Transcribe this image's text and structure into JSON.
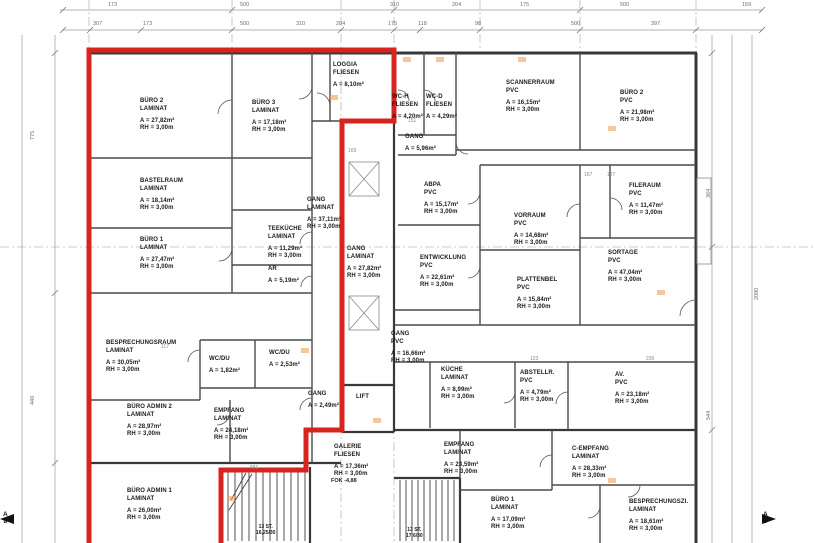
{
  "drawing_type": "floor-plan",
  "colors": {
    "red_outline": "#d8231e",
    "wall": "#383838",
    "dimension_text": "#6f6f6f",
    "marker_orange": "#eca557"
  },
  "rooms": [
    {
      "name": "BÜRO 2",
      "material": "LAMINAT",
      "area": "A = 27,82m²",
      "rh": "RH =  3,00m",
      "x": 140,
      "y": 98
    },
    {
      "name": "BÜRO 3",
      "material": "LAMINAT",
      "area": "A = 17,18m²",
      "rh": "RH =  3,00m",
      "x": 252,
      "y": 100
    },
    {
      "name": "LOGGIA",
      "material": "FLIESEN",
      "area": "A = 8,10m²",
      "rh": "",
      "x": 333,
      "y": 62
    },
    {
      "name": "BASTELRAUM",
      "material": "LAMINAT",
      "area": "A = 18,14m²",
      "rh": "RH =  3,00m",
      "x": 140,
      "y": 178
    },
    {
      "name": "BÜRO 1",
      "material": "LAMINAT",
      "area": "A = 27,47m²",
      "rh": "RH =  3,00m",
      "x": 140,
      "y": 237
    },
    {
      "name": "GANG",
      "material": "LAMINAT",
      "area": "A = 37,11m²",
      "rh": "RH =  3,00m",
      "x": 307,
      "y": 197
    },
    {
      "name": "TEEKÜCHE",
      "material": "LAMINAT",
      "area": "A = 11,29m²",
      "rh": "RH =  3,00m",
      "x": 268,
      "y": 226
    },
    {
      "name": "AR",
      "material": "",
      "area": "A = 5,19m²",
      "rh": "",
      "x": 268,
      "y": 266
    },
    {
      "name": "BESPRECHUNGSRAUM",
      "material": "LAMINAT",
      "area": "A = 30,05m²",
      "rh": "RH =  3,00m",
      "x": 106,
      "y": 340
    },
    {
      "name": "WC/DU",
      "material": "",
      "area": "A = 1,82m²",
      "rh": "",
      "x": 209,
      "y": 356
    },
    {
      "name": "WC/DU",
      "material": "",
      "area": "A = 2,53m²",
      "rh": "",
      "x": 269,
      "y": 350
    },
    {
      "name": "BÜRO ADMIN 2",
      "material": "LAMINAT",
      "area": "A = 28,97m²",
      "rh": "RH =  3,00m",
      "x": 127,
      "y": 404
    },
    {
      "name": "EMPFANG",
      "material": "LAMINAT",
      "area": "A = 24,18m²",
      "rh": "RH =  3,00m",
      "x": 214,
      "y": 408
    },
    {
      "name": "GANG",
      "material": "",
      "area": "A = 2,49m²",
      "rh": "",
      "x": 308,
      "y": 391
    },
    {
      "name": "LIFT",
      "material": "",
      "area": "",
      "rh": "",
      "x": 356,
      "y": 394
    },
    {
      "name": "BÜRO ADMIN 1",
      "material": "LAMINAT",
      "area": "A = 26,00m²",
      "rh": "RH =  3,00m",
      "x": 127,
      "y": 488
    },
    {
      "name": "GALERIE",
      "material": "FLIESEN",
      "area": "A = 17,36m²",
      "rh": "RH =  3,00m",
      "x": 334,
      "y": 444
    },
    {
      "name": "GANG",
      "material": "LAMINAT",
      "area": "A = 27,82m²",
      "rh": "RH =  3,00m",
      "x": 347,
      "y": 246
    },
    {
      "name": "WC-H",
      "material": "FLIESEN",
      "area": "A = 4,20m²",
      "rh": "",
      "x": 392,
      "y": 94
    },
    {
      "name": "WC-D",
      "material": "FLIESEN",
      "area": "A = 4,29m²",
      "rh": "",
      "x": 426,
      "y": 94
    },
    {
      "name": "SCANNERRAUM",
      "material": "PVC",
      "area": "A = 16,15m²",
      "rh": "RH =  3,00m",
      "x": 506,
      "y": 80
    },
    {
      "name": "BÜRO 2",
      "material": "PVC",
      "area": "A = 21,98m²",
      "rh": "RH =  3,00m",
      "x": 620,
      "y": 90
    },
    {
      "name": "GANG",
      "material": "",
      "area": "A = 5,96m²",
      "rh": "",
      "x": 405,
      "y": 134
    },
    {
      "name": "ABPA",
      "material": "PVC",
      "area": "A = 15,17m²",
      "rh": "RH =  3,00m",
      "x": 424,
      "y": 182
    },
    {
      "name": "FILERAUM",
      "material": "PVC",
      "area": "A = 11,47m²",
      "rh": "RH =  3,00m",
      "x": 629,
      "y": 183
    },
    {
      "name": "VORRAUM",
      "material": "PVC",
      "area": "A = 14,68m²",
      "rh": "RH =  3,00m",
      "x": 514,
      "y": 213
    },
    {
      "name": "ENTWICKLUNG",
      "material": "PVC",
      "area": "A = 22,61m²",
      "rh": "RH =  3,00m",
      "x": 420,
      "y": 255
    },
    {
      "name": "SORTAGE",
      "material": "PVC",
      "area": "A = 47,04m²",
      "rh": "RH =  3,00m",
      "x": 608,
      "y": 250
    },
    {
      "name": "PLATTENBEL",
      "material": "PVC",
      "area": "A = 15,84m²",
      "rh": "RH =  3,00m",
      "x": 517,
      "y": 277
    },
    {
      "name": "GANG",
      "material": "PVC",
      "area": "A = 16,66m²",
      "rh": "RH =  3,00m",
      "x": 391,
      "y": 331
    },
    {
      "name": "KÜCHE",
      "material": "LAMINAT",
      "area": "A = 8,99m²",
      "rh": "RH =  3,00m",
      "x": 441,
      "y": 367
    },
    {
      "name": "ABSTELLR.",
      "material": "PVC",
      "area": "A = 4,79m²",
      "rh": "RH =  3,00m",
      "x": 520,
      "y": 370
    },
    {
      "name": "AV.",
      "material": "PVC",
      "area": "A = 23,18m²",
      "rh": "RH =  3,00m",
      "x": 615,
      "y": 372
    },
    {
      "name": "EMPFANG",
      "material": "LAMINAT",
      "area": "A = 23,59m²",
      "rh": "RH =  3,00m",
      "x": 444,
      "y": 442
    },
    {
      "name": "BÜRO 1",
      "material": "LAMINAT",
      "area": "A = 17,09m²",
      "rh": "RH =  3,00m",
      "x": 491,
      "y": 497
    },
    {
      "name": "C-EMPFANG",
      "material": "LAMINAT",
      "area": "A = 28,33m²",
      "rh": "RH =  3,00m",
      "x": 572,
      "y": 446
    },
    {
      "name": "BESPRECHUNGSZI.",
      "material": "LAMINAT",
      "area": "A = 18,61m²",
      "rh": "RH =  3,00m",
      "x": 629,
      "y": 499
    }
  ],
  "stair_labels": [
    {
      "line1": "13 ST.",
      "line2": "16,25/30",
      "x": 256,
      "y": 524
    },
    {
      "line1": "13 ST.",
      "line2": "17,6/30",
      "x": 406,
      "y": 527
    }
  ],
  "wall_note": {
    "text": "FOK -4,88"
  },
  "dimensions": {
    "top_row1": [
      {
        "t": "173",
        "x": 108
      },
      {
        "t": "500",
        "x": 240
      },
      {
        "t": "310",
        "x": 390
      },
      {
        "t": "204",
        "x": 452
      },
      {
        "t": "175",
        "x": 520
      },
      {
        "t": "500",
        "x": 620
      },
      {
        "t": "159",
        "x": 742
      }
    ],
    "top_row2": [
      {
        "t": "307",
        "x": 93
      },
      {
        "t": "173",
        "x": 143
      },
      {
        "t": "500",
        "x": 240
      },
      {
        "t": "310",
        "x": 296
      },
      {
        "t": "204",
        "x": 336
      },
      {
        "t": "175",
        "x": 388
      },
      {
        "t": "118",
        "x": 418
      },
      {
        "t": "98",
        "x": 475
      },
      {
        "t": "500",
        "x": 571
      },
      {
        "t": "397",
        "x": 651
      }
    ],
    "left": [
      {
        "t": "775",
        "x": 30,
        "y": 140
      },
      {
        "t": "440",
        "x": 30,
        "y": 405
      }
    ],
    "right": [
      {
        "t": "364",
        "x": 706,
        "y": 198
      },
      {
        "t": "544",
        "x": 706,
        "y": 420
      },
      {
        "t": "2080",
        "x": 754,
        "y": 300
      }
    ]
  },
  "minor_dims": [
    {
      "t": "169",
      "x": 348,
      "y": 148
    },
    {
      "t": "117",
      "x": 161,
      "y": 344
    },
    {
      "t": "151",
      "x": 408,
      "y": 118
    },
    {
      "t": "167",
      "x": 584,
      "y": 172
    },
    {
      "t": "127",
      "x": 607,
      "y": 172
    },
    {
      "t": "581",
      "x": 250,
      "y": 465
    },
    {
      "t": "123",
      "x": 530,
      "y": 356
    },
    {
      "t": "230",
      "x": 646,
      "y": 356
    }
  ],
  "markers": [
    {
      "x": 330,
      "y": 95
    },
    {
      "x": 403,
      "y": 57
    },
    {
      "x": 436,
      "y": 57
    },
    {
      "x": 518,
      "y": 57
    },
    {
      "x": 608,
      "y": 126
    },
    {
      "x": 301,
      "y": 348
    },
    {
      "x": 373,
      "y": 418
    },
    {
      "x": 608,
      "y": 478
    },
    {
      "x": 227,
      "y": 496
    },
    {
      "x": 657,
      "y": 290
    }
  ],
  "section_markers": {
    "left": {
      "top": "A",
      "bottom": "8"
    },
    "right": {
      "top": "A",
      "bottom": "8"
    }
  }
}
